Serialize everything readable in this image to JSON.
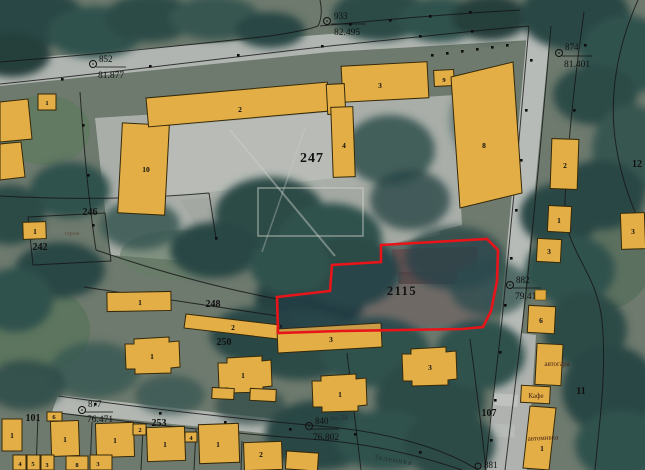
{
  "map": {
    "parcels": {
      "school": "247",
      "target": "2115",
      "p246": "246",
      "p242": "242",
      "p248": "248",
      "p250": "250",
      "p253": "253",
      "p101": "101",
      "p107": "107",
      "p11": "11",
      "p12": "12"
    },
    "quarter_label": "кв. 24",
    "street_name": "Зеленика",
    "place_labels": {
      "garage": "гараж",
      "bus_station": "автогара",
      "cafe": "Кафе",
      "car_wash": "автомивка"
    },
    "survey_points": {
      "p933": {
        "id": "933",
        "elevation": "82.495"
      },
      "p852": {
        "id": "852",
        "elevation": "81.877"
      },
      "p874": {
        "id": "874",
        "elevation": "81.401"
      },
      "p882": {
        "id": "882",
        "elevation": "79.41"
      },
      "p877": {
        "id": "877",
        "elevation": "76.471"
      },
      "p840": {
        "id": "840",
        "elevation": "76.802"
      },
      "p881": {
        "id": "881"
      }
    },
    "building_numbers": {
      "school_b10": "10",
      "school_b2": "2",
      "school_b3": "3",
      "school_b4": "4",
      "school_b9": "9",
      "school_b8": "8",
      "east_b2": "2",
      "east_b1": "1",
      "east_b3": "3",
      "east_b6": "6",
      "east_edge_b3": "3",
      "left_edge_b1": "1",
      "p242_b1": "1",
      "p248_b1": "1",
      "p248_b2": "2",
      "p250_b3": "3",
      "block_a": "1",
      "block_b": "1",
      "block_c": "1",
      "block_d": "3",
      "car_wash_b1": "1",
      "house_1a": "1",
      "house_1b": "1",
      "house_1c": "1",
      "house_1d": "1",
      "house_1e": "1",
      "house_2a": "2",
      "annex_6": "6",
      "annex_2": "2",
      "annex_4": "4",
      "row_4": "4",
      "row_5": "5",
      "row_3a": "3",
      "row_8": "8",
      "row_3b": "3"
    },
    "colors": {
      "building_fill": "#e2ae45",
      "building_stroke": "#35290a",
      "cadastral_line": "#141414",
      "target_outline": "#e81419",
      "label_text": "#111111",
      "place_text": "#49251a"
    }
  }
}
